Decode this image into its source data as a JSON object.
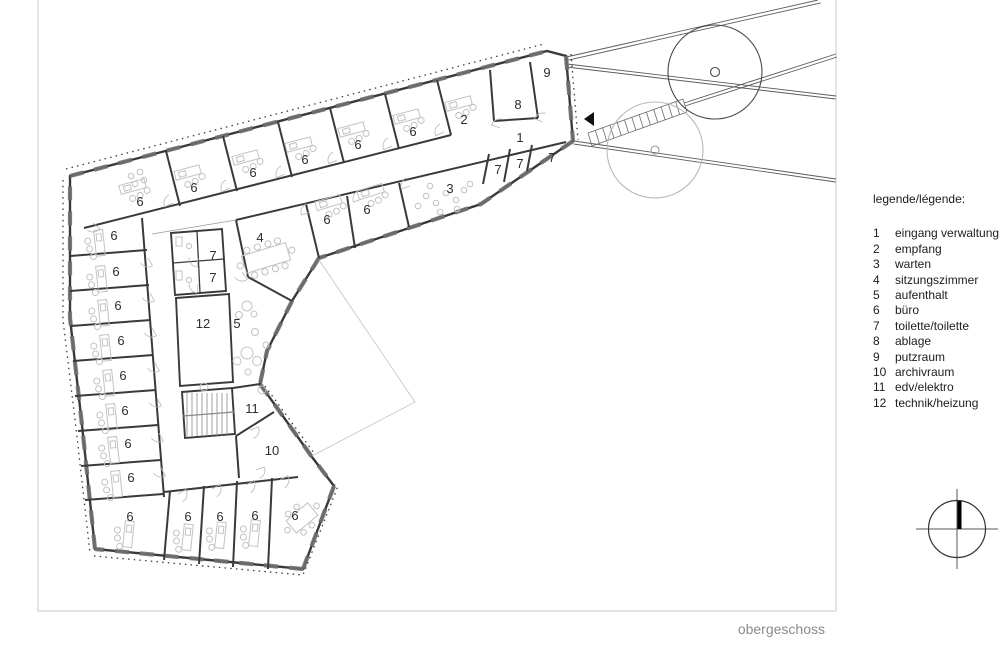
{
  "plan": {
    "title": "obergeschoss",
    "room_labels": [
      {
        "label": "6",
        "x": 140,
        "y": 201
      },
      {
        "label": "6",
        "x": 194,
        "y": 187
      },
      {
        "label": "6",
        "x": 253,
        "y": 172
      },
      {
        "label": "6",
        "x": 305,
        "y": 159
      },
      {
        "label": "6",
        "x": 358,
        "y": 144
      },
      {
        "label": "6",
        "x": 413,
        "y": 131
      },
      {
        "label": "2",
        "x": 464,
        "y": 119
      },
      {
        "label": "8",
        "x": 518,
        "y": 104
      },
      {
        "label": "9",
        "x": 547,
        "y": 72
      },
      {
        "label": "1",
        "x": 520,
        "y": 137
      },
      {
        "label": "7",
        "x": 498,
        "y": 169
      },
      {
        "label": "7",
        "x": 520,
        "y": 163
      },
      {
        "label": "7",
        "x": 552,
        "y": 157
      },
      {
        "label": "3",
        "x": 450,
        "y": 188
      },
      {
        "label": "6",
        "x": 367,
        "y": 209
      },
      {
        "label": "6",
        "x": 327,
        "y": 219
      },
      {
        "label": "4",
        "x": 260,
        "y": 237
      },
      {
        "label": "7",
        "x": 213,
        "y": 255
      },
      {
        "label": "7",
        "x": 213,
        "y": 277
      },
      {
        "label": "12",
        "x": 203,
        "y": 323
      },
      {
        "label": "5",
        "x": 237,
        "y": 323
      },
      {
        "label": "11",
        "x": 252,
        "y": 408
      },
      {
        "label": "10",
        "x": 272,
        "y": 450
      },
      {
        "label": "6",
        "x": 114,
        "y": 235
      },
      {
        "label": "6",
        "x": 116,
        "y": 271
      },
      {
        "label": "6",
        "x": 118,
        "y": 305
      },
      {
        "label": "6",
        "x": 121,
        "y": 340
      },
      {
        "label": "6",
        "x": 123,
        "y": 375
      },
      {
        "label": "6",
        "x": 125,
        "y": 410
      },
      {
        "label": "6",
        "x": 128,
        "y": 443
      },
      {
        "label": "6",
        "x": 131,
        "y": 477
      },
      {
        "label": "6",
        "x": 130,
        "y": 516
      },
      {
        "label": "6",
        "x": 188,
        "y": 516
      },
      {
        "label": "6",
        "x": 220,
        "y": 516
      },
      {
        "label": "6",
        "x": 255,
        "y": 515
      },
      {
        "label": "6",
        "x": 295,
        "y": 515
      }
    ]
  },
  "legend": {
    "title": "legende/légende:",
    "items": [
      {
        "number": "1",
        "label": "eingang verwaltung"
      },
      {
        "number": "2",
        "label": "empfang"
      },
      {
        "number": "3",
        "label": "warten"
      },
      {
        "number": "4",
        "label": "sitzungszimmer"
      },
      {
        "number": "5",
        "label": "aufenthalt"
      },
      {
        "number": "6",
        "label": "büro"
      },
      {
        "number": "7",
        "label": "toilette/toilette"
      },
      {
        "number": "8",
        "label": "ablage"
      },
      {
        "number": "9",
        "label": "putzraum"
      },
      {
        "number": "10",
        "label": "archivraum"
      },
      {
        "number": "11",
        "label": "edv/elektro"
      },
      {
        "number": "12",
        "label": "technik/heizung"
      }
    ]
  },
  "colors": {
    "wall": "#3a3a3a",
    "wall_pier": "#707070",
    "thin_line": "#9a9a9a",
    "courtyard_line": "#c2c2c2",
    "furniture": "#c2c2c2",
    "door_arc": "#b8b8b8",
    "road": "#5a5a5a",
    "tree_dark": "#4a4a4a",
    "tree_light": "#b8b8b8",
    "frame": "#d9d9d9",
    "legend_text": "#1c1c1c",
    "title_text": "#8a8a8a"
  }
}
